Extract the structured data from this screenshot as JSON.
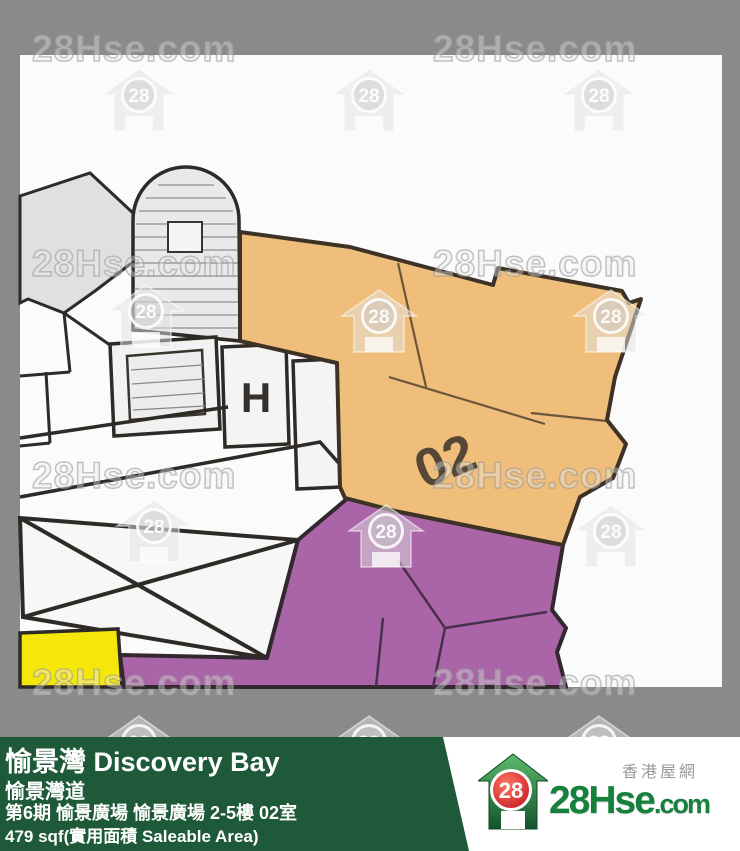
{
  "watermark": {
    "text": "28Hse.com",
    "icon_text": "28"
  },
  "floor_plan": {
    "unit_label": "02",
    "lift_label": "H"
  },
  "footer": {
    "estate_name": "愉景灣 Discovery Bay",
    "street": "愉景灣道",
    "address_detail": "第6期 愉景廣場 愉景廣場 2-5樓 02室",
    "area": "479 sqf(實用面積 Saleable Area)"
  },
  "logo": {
    "brand_main": "28Hse",
    "brand_suffix": ".com",
    "icon_text": "28",
    "tagline": "香港屋網"
  },
  "colors": {
    "background_gray": "#8A8A8A",
    "plan_white": "#FBFBFB",
    "unit_highlight_orange": "#F0BE7B",
    "adjacent_unit_purple": "#A965A7",
    "store_yellow": "#F6E70B",
    "common_room_gray": "#E0E0E0",
    "wall_dark": "#362E26",
    "footer_green": "#1E5939",
    "brand_green": "#15813D",
    "brand_red": "#D42025"
  }
}
